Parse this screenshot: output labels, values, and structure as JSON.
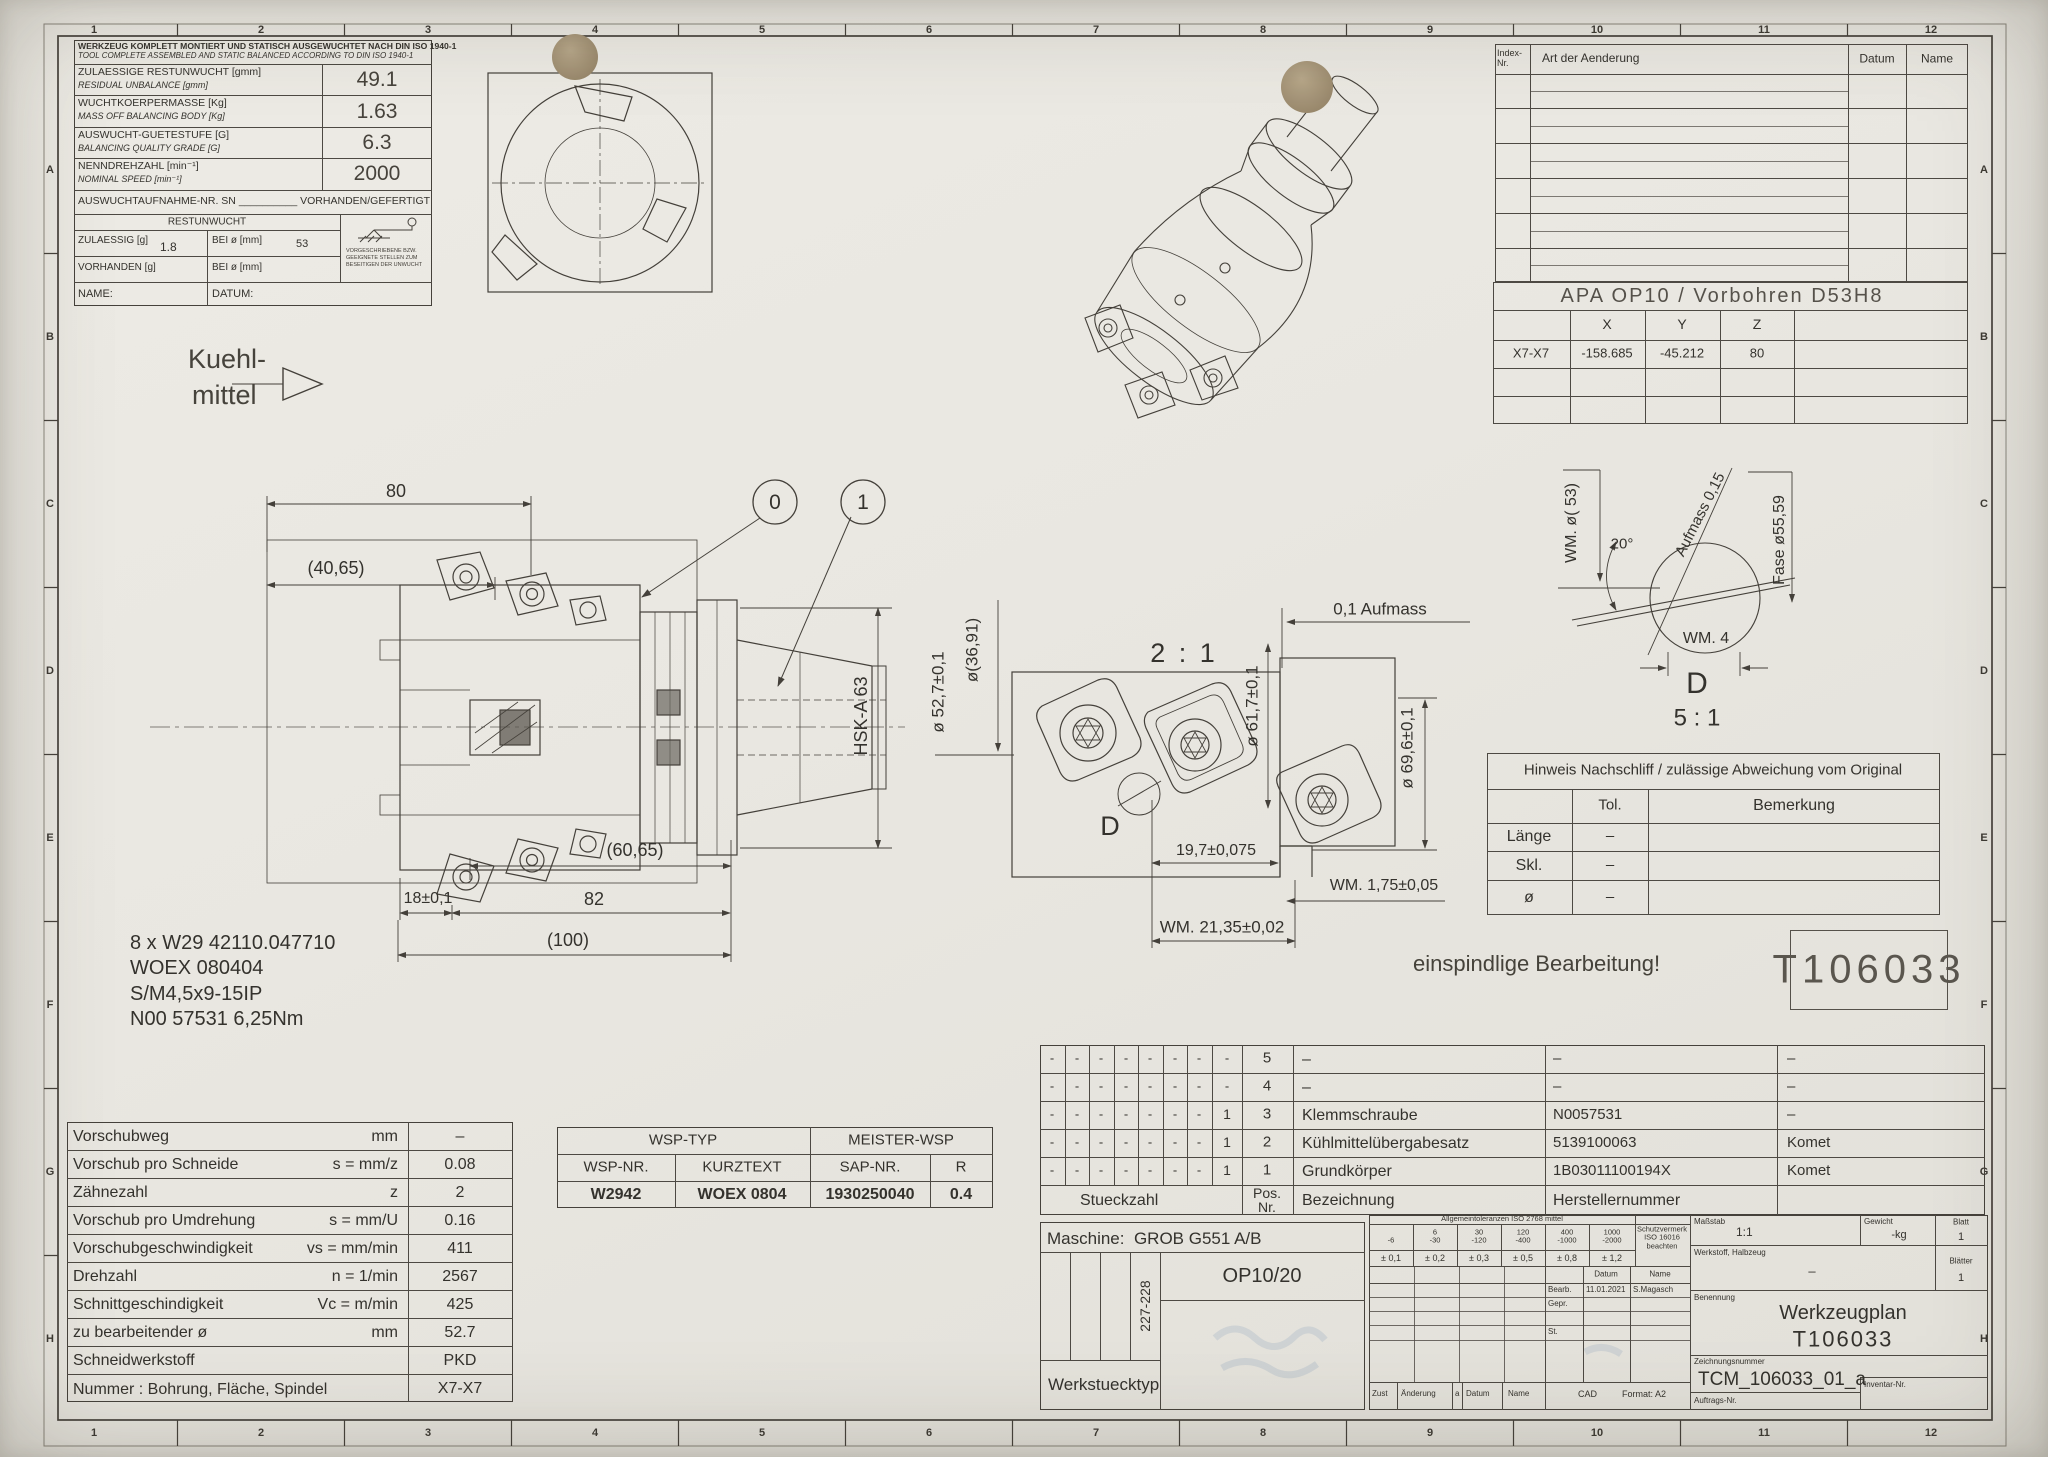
{
  "frame": {
    "zones_h": [
      "1",
      "2",
      "3",
      "4",
      "5",
      "6",
      "7",
      "8",
      "9",
      "10",
      "11",
      "12"
    ],
    "zones_v": [
      "A",
      "B",
      "C",
      "D",
      "E",
      "F",
      "G",
      "H"
    ]
  },
  "balance": {
    "title_de": "WERKZEUG KOMPLETT MONTIERT UND STATISCH AUSGEWUCHTET NACH DIN ISO 1940-1",
    "title_en": "TOOL COMPLETE ASSEMBLED AND STATIC BALANCED ACCORDING TO DIN ISO 1940-1",
    "rows": [
      {
        "de": "ZULAESSIGE RESTUNWUCHT",
        "unit_de": "[gmm]",
        "en": "RESIDUAL UNBALANCE",
        "unit_en": "[gmm]",
        "value": "49.1"
      },
      {
        "de": "WUCHTKOERPERMASSE",
        "unit_de": "[Kg]",
        "en": "MASS OFF BALANCING BODY",
        "unit_en": "[Kg]",
        "value": "1.63"
      },
      {
        "de": "AUSWUCHT-GUETESTUFE [G]",
        "unit_de": "",
        "en": "BALANCING QUALITY GRADE [G]",
        "unit_en": "",
        "value": "6.3"
      },
      {
        "de": "NENNDREHZAHL",
        "unit_de": "[min⁻¹]",
        "en": "NOMINAL SPEED",
        "unit_en": "[min⁻¹]",
        "value": "2000"
      }
    ],
    "sn_label": "AUSWUCHTAUFNAHME-NR. SN",
    "sn_blank": "__________",
    "sn_suffix": "VORHANDEN/GEFERTIGT",
    "rest_title": "RESTUNWUCHT",
    "zul_label": "ZULAESSIG [g]",
    "zul_value": "1.8",
    "bei1_label": "BEI ø [mm]",
    "bei1_value": "53",
    "vor_label": "VORHANDEN [g]",
    "bei2_label": "BEI ø [mm]",
    "name_label": "NAME:",
    "datum_label": "DATUM:",
    "icon_note": "VORGESCHRIEBENE BZW. GEEIGNETE STELLEN ZUM BESEITIGEN DER UNWUCHT"
  },
  "revision": {
    "index1": "Index-",
    "index2": "Nr.",
    "art": "Art der Aenderung",
    "datum": "Datum",
    "name": "Name"
  },
  "apa": {
    "title": "APA OP10 / Vorbohren D53H8",
    "col_x": "X",
    "col_y": "Y",
    "col_z": "Z",
    "row_label": "X7-X7",
    "x": "-158.685",
    "y": "-45.212",
    "z": "80"
  },
  "coolant": {
    "line1": "Kuehl-",
    "line2": "mittel"
  },
  "main_view": {
    "dim_80": "80",
    "dim_4065": "(40,65)",
    "dim_6065": "(60,65)",
    "dim_18": "18±0,1",
    "dim_82": "82",
    "dim_100": "(100)",
    "hsk": "HSK-A 63",
    "balloon_0": "0",
    "balloon_1": "1"
  },
  "notes": {
    "l1": "8 x W29 42110.047710",
    "l2": "WOEX 080404",
    "l3": "S/M4,5x9-15IP",
    "l4": "N00 57531 6,25Nm"
  },
  "detail21": {
    "scale": "2 : 1",
    "dim_527": "ø 52,7±0,1",
    "dim_3691": "ø(36,91)",
    "dim_617": "ø 61,7±0,1",
    "dim_696": "ø 69,6±0,1",
    "dim_197": "19,7±0,075",
    "dim_175": "WM. 1,75±0,05",
    "dim_2135": "WM. 21,35±0,02",
    "dim_aufmass": "0,1 Aufmass",
    "d_label": "D"
  },
  "detailD": {
    "dim_53": "WM. ø( 53)",
    "dim_20": "20°",
    "dim_aufmass": "Aufmass 0,15",
    "dim_fase": "Fase ø55,59",
    "dim_wm4": "WM. 4",
    "label": "D",
    "scale": "5 : 1"
  },
  "nachschliff": {
    "title": "Hinweis Nachschliff / zulässige Abweichung vom Original",
    "col_tol": "Tol.",
    "col_bem": "Bemerkung",
    "rows": [
      {
        "label": "Länge",
        "tol": "–"
      },
      {
        "label": "Skl.",
        "tol": "–"
      },
      {
        "label": "ø",
        "tol": "–"
      }
    ]
  },
  "note_single": "einspindlige Bearbeitung!",
  "tool_no": "T106033",
  "cutting": {
    "rows": [
      {
        "label": "Vorschubweg",
        "formula": "mm",
        "value": "–"
      },
      {
        "label": "Vorschub pro Schneide",
        "formula": "s = mm/z",
        "value": "0.08"
      },
      {
        "label": "Zähnezahl",
        "formula": "z",
        "value": "2"
      },
      {
        "label": "Vorschub pro Umdrehung",
        "formula": "s = mm/U",
        "value": "0.16"
      },
      {
        "label": "Vorschubgeschwindigkeit",
        "formula": "vs = mm/min",
        "value": "411"
      },
      {
        "label": "Drehzahl",
        "formula": "n = 1/min",
        "value": "2567"
      },
      {
        "label": "Schnittgeschindigkeit",
        "formula": "Vc = m/min",
        "value": "425"
      },
      {
        "label": "zu bearbeitender ø",
        "formula": "mm",
        "value": "52.7"
      },
      {
        "label": "Schneidwerkstoff",
        "formula": "",
        "value": "PKD"
      },
      {
        "label": "Nummer : Bohrung, Fläche, Spindel",
        "formula": "",
        "value": "X7-X7"
      }
    ]
  },
  "wsp": {
    "h1": "WSP-TYP",
    "h2": "MEISTER-WSP",
    "c1": "WSP-NR.",
    "c2": "KURZTEXT",
    "c3": "SAP-NR.",
    "c4": "R",
    "v1": "W2942",
    "v2": "WOEX 0804",
    "v3": "1930250040",
    "v4": "0.4"
  },
  "parts": {
    "h_stueck": "Stueckzahl",
    "h_pos1": "Pos.",
    "h_pos2": "Nr.",
    "h_bez": "Bezeichnung",
    "h_mfr": "Herstellernummer",
    "rows": [
      {
        "counts": [
          "-",
          "-",
          "-",
          "-",
          "-",
          "-",
          "-",
          "-"
        ],
        "pos": "5",
        "name": "–",
        "mfr": "–",
        "sup": "–"
      },
      {
        "counts": [
          "-",
          "-",
          "-",
          "-",
          "-",
          "-",
          "-",
          "-"
        ],
        "pos": "4",
        "name": "–",
        "mfr": "–",
        "sup": "–"
      },
      {
        "counts": [
          "-",
          "-",
          "-",
          "-",
          "-",
          "-",
          "-",
          "1"
        ],
        "pos": "3",
        "name": "Klemmschraube",
        "mfr": "N0057531",
        "sup": "–"
      },
      {
        "counts": [
          "-",
          "-",
          "-",
          "-",
          "-",
          "-",
          "-",
          "1"
        ],
        "pos": "2",
        "name": "Kühlmittelübergabesatz",
        "mfr": "5139100063",
        "sup": "Komet"
      },
      {
        "counts": [
          "-",
          "-",
          "-",
          "-",
          "-",
          "-",
          "-",
          "1"
        ],
        "pos": "1",
        "name": "Grundkörper",
        "mfr": "1B03011100194X",
        "sup": "Komet"
      }
    ]
  },
  "machine": {
    "label": "Maschine:",
    "value": "GROB G551 A/B",
    "range": "227-228",
    "op": "OP10/20",
    "werkstueck": "Werkstuecktyp"
  },
  "titleblock": {
    "tol_title": "Allgemeintoleranzen ISO 2768 mittel",
    "tol_cols": [
      {
        "hi": "",
        "lo": "-6",
        "tol": "± 0,1"
      },
      {
        "hi": "6",
        "lo": "-30",
        "tol": "± 0,2"
      },
      {
        "hi": "30",
        "lo": "-120",
        "tol": "± 0,3"
      },
      {
        "hi": "120",
        "lo": "-400",
        "tol": "± 0,5"
      },
      {
        "hi": "400",
        "lo": "-1000",
        "tol": "± 0,8"
      },
      {
        "hi": "1000",
        "lo": "-2000",
        "tol": "± 1,2"
      }
    ],
    "schutz1": "Schutzvermerk",
    "schutz2": "ISO 16016",
    "schutz3": "beachten",
    "massstab_label": "Maßstab",
    "massstab": "1:1",
    "gewicht_label": "Gewicht",
    "gewicht": "-kg",
    "blatt_label": "Blatt",
    "blatt": "1",
    "werkstoff_label": "Werkstoff, Halbzeug",
    "werkstoff": "–",
    "blaetter_label": "Blätter",
    "blaetter": "1",
    "benennung_label": "Benennung",
    "benennung1": "Werkzeugplan",
    "benennung2": "T106033",
    "zeichnung_label": "Zeichnungsnummer",
    "zeichnung": "TCM_106033_01_a",
    "auftrag_label": "Auftrags-Nr.",
    "inventar_label": "Inventar-Nr.",
    "datum_h": "Datum",
    "name_h": "Name",
    "bearb_label": "Bearb.",
    "bearb_datum": "11.01.2021",
    "bearb_name": "S.Magasch",
    "gepr_label": "Gepr.",
    "st_label": "St.",
    "cad": "CAD",
    "format_label": "Format:",
    "format": "A2",
    "zust": "Zust",
    "aenderung": "Änderung",
    "a_col": "a",
    "datum2": "Datum",
    "name2": "Name"
  }
}
